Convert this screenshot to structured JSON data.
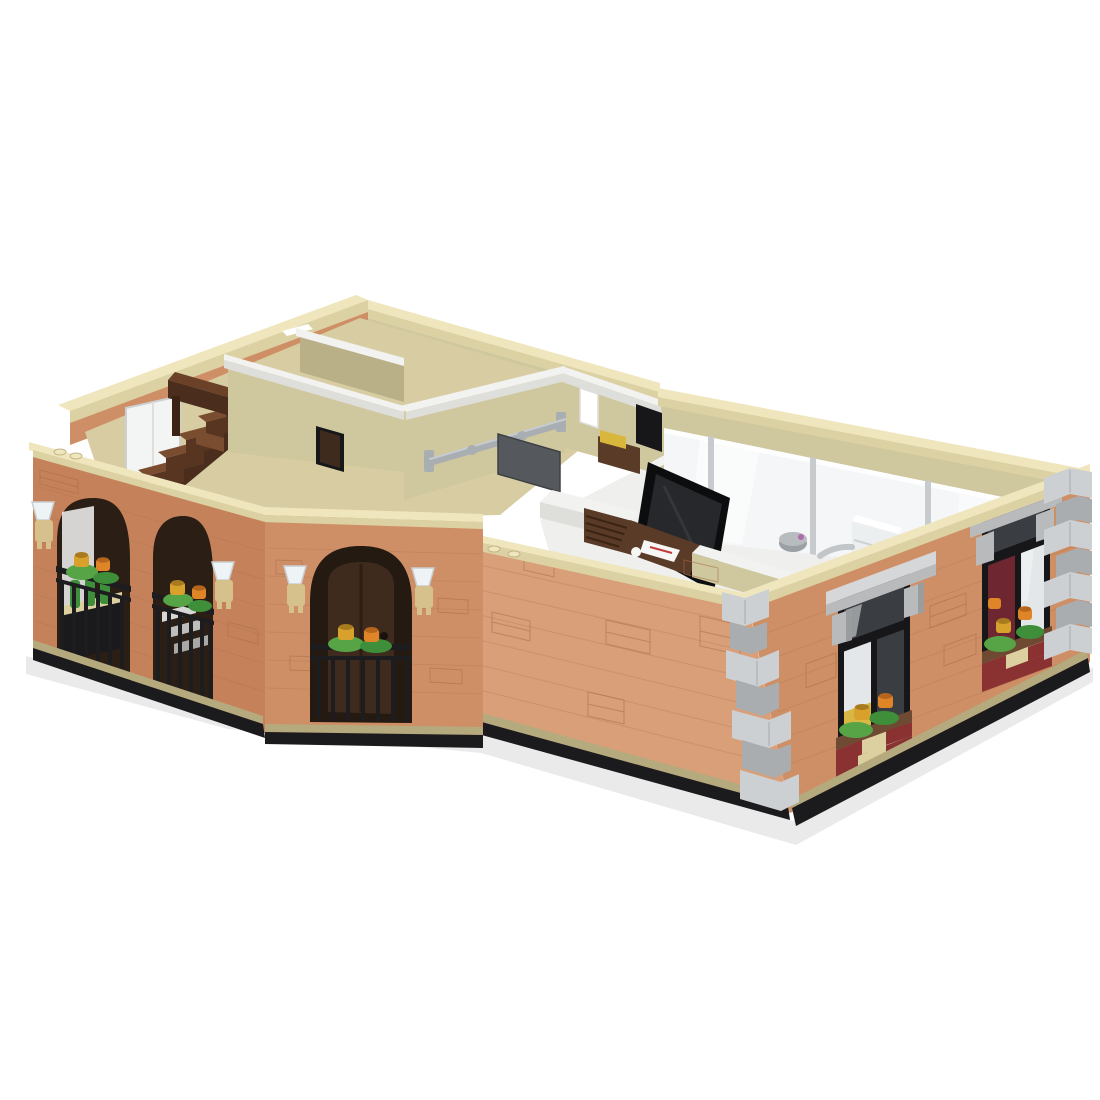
{
  "scene": {
    "title": "LEGO-style modular corner building render, aerial three-quarter view with open top showing interior rooms",
    "background": "#ffffff"
  },
  "palette": {
    "bg": "#ffffff",
    "coping_top": "#efe6bd",
    "coping_side": "#dcd1a3",
    "coping_dark": "#c2b789",
    "nougat_light": "#d89f78",
    "nougat_mid": "#cf8f66",
    "nougat_deep": "#c5825a",
    "brick_line": "#a86e48",
    "base_tan": "#b5aa7e",
    "base_black": "#1b1b1e",
    "quoin_light": "#cdd0d2",
    "quoin_mid": "#aaadaf",
    "quoin_dark": "#8e9194",
    "stone_light": "#d5d7d9",
    "stone_mid": "#b8babc",
    "stone_dark": "#9a9c9e",
    "frame_black": "#17171a",
    "glass_dark": "#3a3e42",
    "glass_light": "#f4f6f7",
    "glass_mid": "#e3e7e9",
    "mullion_gray": "#c7cbcd",
    "curtain_red": "#6e2731",
    "glow_yellow": "#d8b843",
    "olive_light": "#cfc79e",
    "olive_mid": "#b9b088",
    "olive_dark": "#a29974",
    "cap_white": "#f2f2f0",
    "cap_side": "#dededa",
    "floor_tan": "#d8cda2",
    "floor_white": "#efefed",
    "stair_top": "#7a4c30",
    "stair_front": "#573520",
    "stair_dark": "#4a2d1c",
    "bar_top": "#6b4128",
    "bar_front": "#4a2d1c",
    "bar_dark": "#3c2414",
    "door_brown": "#3f2b1d",
    "leaf_green": "#57a447",
    "leaf_dark": "#3f8f3a",
    "flower_orange": "#e08428",
    "flower_orange_dark": "#b5661c",
    "flower_gold": "#d8a12c",
    "flower_gold_dark": "#a87b1e",
    "box_red": "#8a3232",
    "box_tan": "#ddd0a0",
    "soil_brown": "#6f4a33",
    "lamp_tan": "#d6c08b",
    "lamp_glass": "#eef3f5",
    "railing_black": "#1d1d20",
    "pipe_gray": "#a9aeb2",
    "panel_gray": "#55585c",
    "tv_black": "#0c0d0f",
    "tv_screen": "#26282c",
    "paper_white": "#f6f6f4",
    "paper_red": "#c23b3b",
    "bottle_green": "#3e8f3c",
    "mirror_white": "#f3f4f4",
    "white": "#ffffff",
    "shelf_brown": "#5a3b28",
    "cushion_yellow": "#d9b63c",
    "bin_gray": "#9aa0a4",
    "shadow_gray": "#d9d9d9"
  },
  "structure": {
    "left_wing": {
      "arched_openings": 2,
      "wall_lamps": 2,
      "balcony_railings": 2,
      "flower_pairs": 2
    },
    "corner_bay": {
      "arched_openings": 1,
      "doors": 1,
      "wall_lamps": 2,
      "flower_pairs": 1
    },
    "right_wing": {
      "sash_windows": 2,
      "stone_lintels": 2,
      "window_flower_boxes": 2,
      "quoin_columns": 2,
      "rear_glass_panels": 4
    },
    "interior": {
      "staircase_steps": 5,
      "visible_rooms": 6,
      "furniture": [
        "bar counter",
        "staircase",
        "mirror wall",
        "wall rail",
        "wall panel",
        "tv screen",
        "desk with papers",
        "shelf with cushion",
        "kitchen counter",
        "louver shutter",
        "waste bin",
        "copier boxes"
      ]
    },
    "base": {
      "plate_color_key": "base_black",
      "trim_color_key": "base_tan"
    }
  }
}
